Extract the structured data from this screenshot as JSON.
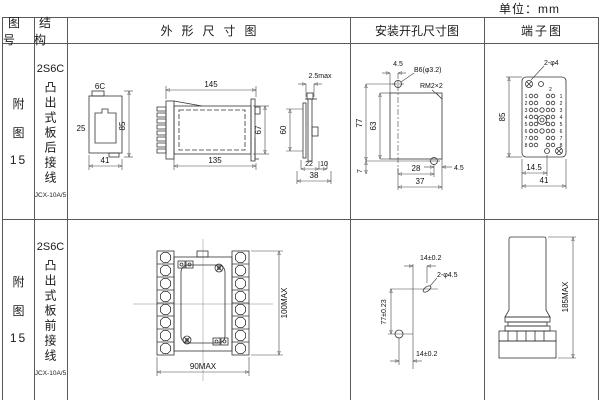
{
  "page": {
    "unit_label": "单位：mm"
  },
  "header": {
    "col_figure": "图号",
    "col_structure": "结构",
    "col_outline": "外形尺寸图",
    "col_mounting": "安装开孔尺寸图",
    "col_terminal": "端子图"
  },
  "rows": [
    {
      "figure_lines": [
        "附",
        "图",
        "15"
      ],
      "structure": {
        "model": "2S6C",
        "type_vertical": "凸出式板后接线",
        "code": "JCX-10A/5"
      },
      "outline": {
        "front": {
          "top": "6C",
          "left": "25",
          "right": "85",
          "bottom": "41"
        },
        "side": {
          "top": "145",
          "bottom": "135",
          "right": "67"
        },
        "panel": {
          "top": "2.5max",
          "left": "60",
          "bottom_a": "22",
          "bottom_b": "10",
          "bottom_total": "38"
        }
      },
      "mounting": {
        "top_offset": "4.5",
        "hole_label": "B6(φ3.2)",
        "thread_label": "RM2×2",
        "height_outer": "77",
        "height_inner": "63",
        "bottom_left": "7",
        "width_inner": "28",
        "width_outer": "37",
        "right_offset": "4.5"
      },
      "terminal": {
        "hole_label": "2-φ4",
        "corner_mark": "2",
        "height": "85",
        "width_inner": "14.5",
        "width_outer": "41",
        "pins": [
          "1",
          "2",
          "3",
          "4",
          "5",
          "6",
          "7",
          "8"
        ]
      }
    },
    {
      "figure_lines": [
        "附",
        "图",
        "15"
      ],
      "structure": {
        "model": "2S6C",
        "type_vertical": "凸出式板前接线",
        "code": "JCX-10A/5"
      },
      "outline": {
        "width": "90MAX",
        "height": "100MAX"
      },
      "mounting": {
        "top": "14±0.2",
        "hole_label": "2-φ4.5",
        "height": "77±0.23",
        "bottom": "14±0.2"
      },
      "terminal": {
        "height": "185MAX"
      }
    }
  ]
}
